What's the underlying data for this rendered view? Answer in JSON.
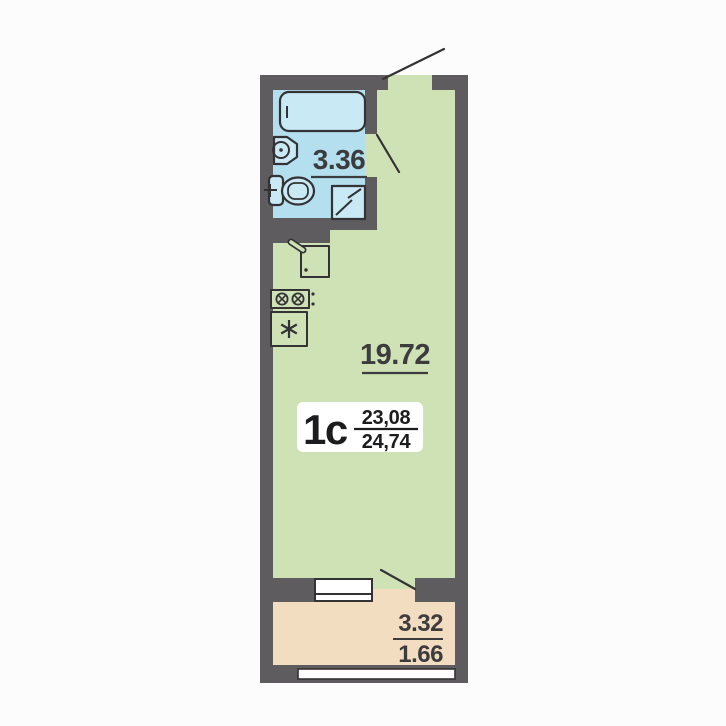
{
  "floor_plan": {
    "unit": {
      "label": "1с",
      "area_total": "23,08",
      "area_reduced": "24,74"
    },
    "areas": {
      "bathroom": "3.36",
      "living_kitchen": "19.72",
      "balcony_full": "3.32",
      "balcony_reduced": "1.66"
    },
    "icons": {
      "bathtub": "bathtub-plan-symbol",
      "sink": "washbasin-plan-symbol",
      "toilet": "toilet-plan-symbol",
      "shower": "shower-tray-diagonal-symbol",
      "kitchen_sink": "kitchen-sink-with-faucet-symbol",
      "stove": "two-burner-stove-symbol",
      "fridge": "fridge-six-spoke-asterisk-symbol",
      "door": "door-swing-line"
    },
    "colors": {
      "background": "#fcfcfc",
      "wall": "#5e5c5f",
      "room": "#cfe2b5",
      "bathroom": "#b4dfee",
      "fixture": "#c9e9f5",
      "balcony": "#f3ddc1",
      "window": "#ffffff",
      "line": "#333335",
      "text": "#3c3c3e",
      "unit_text": "#1c1c1e",
      "label_box": "#ffffff"
    }
  }
}
